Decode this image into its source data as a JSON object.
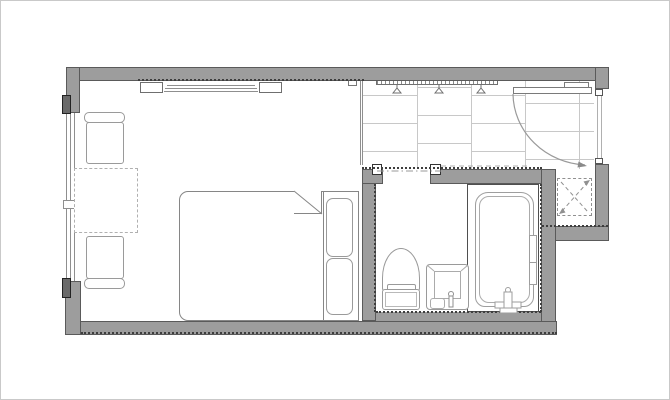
{
  "meta": {
    "drawing_type": "architectural floor plan",
    "description": "Studio / hotel guest room floor plan with bedroom-living area, tiled entry hall, bathroom with WC, sink and bathtub, and a service shaft",
    "visible_text": "none"
  },
  "palette": {
    "background": "#ffffff",
    "frame_border": "#c9c9c9",
    "wall_fill": "#9d9d9d",
    "wall_edge": "#5a5a5a",
    "hatch_dots": "#3e3e3e",
    "furniture_line": "#868686",
    "fixture_line": "#9a9a9a",
    "tile_line": "#c8c8c8",
    "dash_line": "#a8a8a8",
    "window_cap": "#6a6a6a"
  },
  "rooms": {
    "bedroom": {
      "label": "Bedroom / living area"
    },
    "entry": {
      "label": "Entry hall (tiled floor)"
    },
    "bathroom": {
      "label": "Bathroom"
    },
    "shower": {
      "label": "Bathtub compartment"
    },
    "shaft": {
      "label": "Service shaft (dashed cross)"
    }
  },
  "fixtures": {
    "bed": {
      "label": "Double bed with duvet fold and two pillows"
    },
    "pillow1": {
      "label": "Pillow"
    },
    "pillow2": {
      "label": "Pillow"
    },
    "chair1": {
      "label": "Chair (facing table, top)"
    },
    "chair2": {
      "label": "Chair (facing table, bottom)"
    },
    "table": {
      "label": "Table (dashed outline)"
    },
    "console": {
      "label": "Wall console / shelf with end blocks"
    },
    "rail": {
      "label": "Coat rail with 3 hangers"
    },
    "window": {
      "label": "Window in left wall"
    },
    "entry_door": {
      "label": "Entrance door with 90-degree swing arc"
    },
    "bath_door": {
      "label": "Bathroom sliding door (dash-dot track)"
    },
    "toilet": {
      "label": "Toilet with tank"
    },
    "sink": {
      "label": "Wash basin with faucet"
    },
    "bathtub": {
      "label": "Bathtub with faucet"
    },
    "grab_bar": {
      "label": "Grab bar / shower rail"
    }
  }
}
